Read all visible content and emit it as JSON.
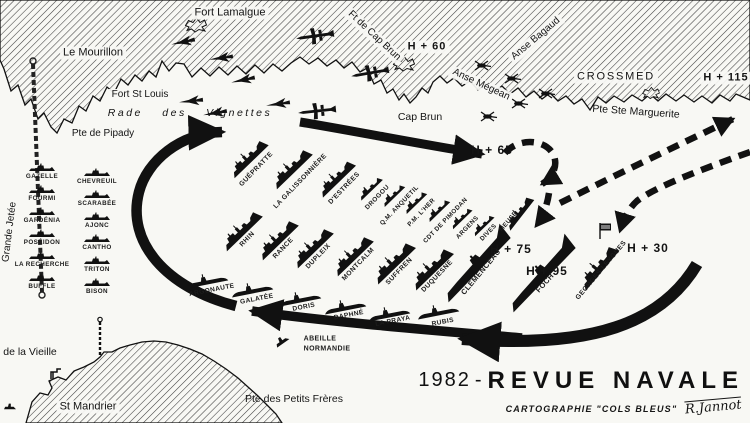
{
  "title_block": {
    "year": "1982",
    "sep": "-",
    "title": "REVUE NAVALE",
    "credit": "CARTOGRAPHIE \"COLS BLEUS\"",
    "signature": "R.Jannot"
  },
  "colors": {
    "ink": "#111111",
    "paper": "#f8f8f4",
    "hatch": "#3f3f3f"
  },
  "labels": [
    {
      "id": "fort-lamalgue",
      "t": "Fort Lamalgue",
      "x": 230,
      "y": 13,
      "fs": 11,
      "cls": "halo"
    },
    {
      "id": "le-mourillon",
      "t": "Le Mourillon",
      "x": 93,
      "y": 53,
      "fs": 11,
      "cls": "halo"
    },
    {
      "id": "fort-st-louis",
      "t": "Fort St Louis",
      "x": 140,
      "y": 95,
      "fs": 10,
      "cls": "halo"
    },
    {
      "id": "rade-des-vignettes",
      "t": "Rade des Vignettes",
      "x": 190,
      "y": 113,
      "fs": 10.5,
      "cls": "water"
    },
    {
      "id": "pte-de-pipady",
      "t": "Pte de Pipady",
      "x": 103,
      "y": 134,
      "fs": 10
    },
    {
      "id": "ft-de-cap-brun",
      "t": "Ft de Cap Brun",
      "x": 374,
      "y": 36,
      "fs": 10,
      "r": 43,
      "cls": "halo"
    },
    {
      "id": "h-60",
      "t": "H + 60",
      "x": 427,
      "y": 47,
      "fs": 11,
      "cls": "tm halo"
    },
    {
      "id": "cap-brun",
      "t": "Cap Brun",
      "x": 420,
      "y": 117,
      "fs": 10.5
    },
    {
      "id": "anse-megean",
      "t": "Anse Mégean",
      "x": 481,
      "y": 85,
      "fs": 10,
      "r": 25,
      "cls": "halo"
    },
    {
      "id": "anse-bagaud",
      "t": "Anse Bagaud",
      "x": 536,
      "y": 39,
      "fs": 10,
      "r": -40,
      "cls": "halo"
    },
    {
      "id": "crossmed",
      "t": "CROSSMED",
      "x": 616,
      "y": 77,
      "fs": 11,
      "cls": "wide halo"
    },
    {
      "id": "h-115",
      "t": "H + 115",
      "x": 726,
      "y": 78,
      "fs": 11,
      "cls": "tm halo"
    },
    {
      "id": "pte-ste-marguerite",
      "t": "Pte Ste Marguerite",
      "x": 636,
      "y": 112,
      "fs": 10.5,
      "r": 4
    },
    {
      "id": "grande-jetee",
      "t": "Grande Jetée",
      "x": 10,
      "y": 232,
      "fs": 10,
      "r": -83
    },
    {
      "id": "h-65",
      "t": "H + 65",
      "x": 492,
      "y": 150,
      "fs": 12,
      "cls": "tm"
    },
    {
      "id": "h-75",
      "t": "H + 75",
      "x": 511,
      "y": 249,
      "fs": 12,
      "cls": "tm"
    },
    {
      "id": "h-95",
      "t": "H + 95",
      "x": 547,
      "y": 271,
      "fs": 12,
      "cls": "tm"
    },
    {
      "id": "h-30",
      "t": "H + 30",
      "x": 648,
      "y": 248,
      "fs": 12,
      "cls": "tm"
    },
    {
      "id": "de-la-vieille",
      "t": "de la Vieille",
      "x": 30,
      "y": 352,
      "fs": 10.5
    },
    {
      "id": "st-mandrier",
      "t": "St Mandrier",
      "x": 88,
      "y": 407,
      "fs": 11,
      "cls": "halo"
    },
    {
      "id": "pte-des-petits-freres",
      "t": "Pte des Petits Frères",
      "x": 294,
      "y": 399,
      "fs": 10.5
    },
    {
      "id": "abeille-line1",
      "t": "ABEILLE",
      "x": 320,
      "y": 339,
      "fs": 7,
      "cls": "ship"
    },
    {
      "id": "abeille-line2",
      "t": "NORMANDIE",
      "x": 327,
      "y": 349,
      "fs": 7,
      "cls": "ship"
    },
    {
      "id": "guepratte",
      "t": "GUÉPRATTE",
      "x": 257,
      "y": 170,
      "fs": 6.8,
      "r": -46,
      "cls": "ship"
    },
    {
      "id": "la-galissonniere",
      "t": "LA GALISSONNIÈRE",
      "x": 301,
      "y": 182,
      "fs": 6.8,
      "r": -46,
      "cls": "ship"
    },
    {
      "id": "d-estrees",
      "t": "D'ESTRÉES",
      "x": 345,
      "y": 189,
      "fs": 6.8,
      "r": -46,
      "cls": "ship"
    },
    {
      "id": "drogou",
      "t": "DROGOU",
      "x": 378,
      "y": 198,
      "fs": 6.5,
      "r": -46,
      "cls": "ship"
    },
    {
      "id": "qm-anquetil",
      "t": "Q.M. ANQUETIL",
      "x": 400,
      "y": 206,
      "fs": 6.3,
      "r": -46,
      "cls": "ship"
    },
    {
      "id": "pm-lher",
      "t": "P.M. L'HER",
      "x": 422,
      "y": 213,
      "fs": 6.3,
      "r": -46,
      "cls": "ship"
    },
    {
      "id": "cdt-de-pimodan",
      "t": "CDT DE PIMODAN",
      "x": 446,
      "y": 221,
      "fs": 6.3,
      "r": -46,
      "cls": "ship"
    },
    {
      "id": "argens",
      "t": "ARGENS",
      "x": 468,
      "y": 228,
      "fs": 6.3,
      "r": -46,
      "cls": "ship"
    },
    {
      "id": "dives",
      "t": "DIVES",
      "x": 489,
      "y": 233,
      "fs": 6.3,
      "r": -46,
      "cls": "ship"
    },
    {
      "id": "rhin",
      "t": "RHIN",
      "x": 248,
      "y": 240,
      "fs": 6.8,
      "r": -46,
      "cls": "ship"
    },
    {
      "id": "rance",
      "t": "RANCE",
      "x": 284,
      "y": 249,
      "fs": 6.8,
      "r": -46,
      "cls": "ship"
    },
    {
      "id": "dupleix",
      "t": "DUPLEIX",
      "x": 319,
      "y": 257,
      "fs": 6.8,
      "r": -46,
      "cls": "ship"
    },
    {
      "id": "montcalm",
      "t": "MONTCALM",
      "x": 359,
      "y": 265,
      "fs": 6.8,
      "r": -46,
      "cls": "ship"
    },
    {
      "id": "suffren",
      "t": "SUFFREN",
      "x": 400,
      "y": 272,
      "fs": 6.8,
      "r": -46,
      "cls": "ship"
    },
    {
      "id": "duquesne",
      "t": "DUQUESNE",
      "x": 438,
      "y": 277,
      "fs": 6.8,
      "r": -46,
      "cls": "ship"
    },
    {
      "id": "clemenceau",
      "t": "CLEMENCEAU",
      "x": 481,
      "y": 272,
      "fs": 7.5,
      "r": -50,
      "cls": "ship"
    },
    {
      "id": "foch",
      "t": "FOCH",
      "x": 545,
      "y": 283,
      "fs": 7.5,
      "r": -48,
      "cls": "ship"
    },
    {
      "id": "meuse",
      "t": "MEUSE",
      "x": 509,
      "y": 222,
      "fs": 6.3,
      "r": -50,
      "cls": "ship"
    },
    {
      "id": "georges-leygues",
      "t": "GEORGES LEYGUES",
      "x": 602,
      "y": 271,
      "fs": 6.8,
      "r": -50,
      "cls": "ship"
    },
    {
      "id": "argonaute",
      "t": "ARGONAUTE",
      "x": 212,
      "y": 291,
      "fs": 6.6,
      "r": -11,
      "cls": "ship"
    },
    {
      "id": "galatee",
      "t": "GALATÉE",
      "x": 257,
      "y": 300,
      "fs": 6.6,
      "r": -11,
      "cls": "ship"
    },
    {
      "id": "doris",
      "t": "DORIS",
      "x": 304,
      "y": 308,
      "fs": 6.6,
      "r": -11,
      "cls": "ship"
    },
    {
      "id": "daphne",
      "t": "DAPHNÉ",
      "x": 349,
      "y": 316,
      "fs": 6.6,
      "r": -11,
      "cls": "ship"
    },
    {
      "id": "la-praya",
      "t": "LA PRAYA",
      "x": 393,
      "y": 322,
      "fs": 6.6,
      "r": -11,
      "cls": "ship"
    },
    {
      "id": "rubis",
      "t": "RUBIS",
      "x": 443,
      "y": 323,
      "fs": 6.6,
      "r": -11,
      "cls": "ship"
    },
    {
      "id": "gazelle",
      "t": "GAZELLE",
      "x": 42,
      "y": 177,
      "fs": 6.3,
      "cls": "ship"
    },
    {
      "id": "fourmi",
      "t": "FOURMI",
      "x": 42,
      "y": 199,
      "fs": 6.3,
      "cls": "ship"
    },
    {
      "id": "gardenia",
      "t": "GARDÉNIA",
      "x": 42,
      "y": 221,
      "fs": 6.3,
      "cls": "ship"
    },
    {
      "id": "poseidon",
      "t": "POSÉIDON",
      "x": 42,
      "y": 243,
      "fs": 6.3,
      "cls": "ship"
    },
    {
      "id": "la-recherche",
      "t": "LA RECHERCHE",
      "x": 42,
      "y": 265,
      "fs": 6.3,
      "cls": "ship"
    },
    {
      "id": "buffle",
      "t": "BUFFLE",
      "x": 42,
      "y": 287,
      "fs": 6.3,
      "cls": "ship"
    },
    {
      "id": "chevreuil",
      "t": "CHEVREUIL",
      "x": 97,
      "y": 182,
      "fs": 6.3,
      "cls": "ship"
    },
    {
      "id": "scarabee",
      "t": "SCARABÉE",
      "x": 97,
      "y": 204,
      "fs": 6.3,
      "cls": "ship"
    },
    {
      "id": "ajonc",
      "t": "AJONC",
      "x": 97,
      "y": 226,
      "fs": 6.3,
      "cls": "ship"
    },
    {
      "id": "cantho",
      "t": "CANTHO",
      "x": 97,
      "y": 248,
      "fs": 6.3,
      "cls": "ship"
    },
    {
      "id": "triton",
      "t": "TRITON",
      "x": 97,
      "y": 270,
      "fs": 6.3,
      "cls": "ship"
    },
    {
      "id": "bison",
      "t": "BISON",
      "x": 97,
      "y": 292,
      "fs": 6.3,
      "cls": "ship"
    }
  ],
  "icons": [
    {
      "id": "ship-guepratte",
      "sym": "escort",
      "x": 247,
      "y": 157,
      "r": -44,
      "s": 0.95
    },
    {
      "id": "ship-la-galissonniere",
      "sym": "escort",
      "x": 290,
      "y": 167,
      "r": -44,
      "s": 1
    },
    {
      "id": "ship-d-estrees",
      "sym": "escort",
      "x": 335,
      "y": 177,
      "r": -44,
      "s": 0.92
    },
    {
      "id": "ship-drogou",
      "sym": "aviso",
      "x": 369,
      "y": 187,
      "r": -44,
      "s": 1
    },
    {
      "id": "ship-qm-anquetil",
      "sym": "aviso",
      "x": 392,
      "y": 194,
      "r": -44,
      "s": 0.95
    },
    {
      "id": "ship-pm-lher",
      "sym": "aviso",
      "x": 414,
      "y": 201,
      "r": -44,
      "s": 0.95
    },
    {
      "id": "ship-cdt-de-pimodan",
      "sym": "aviso",
      "x": 437,
      "y": 209,
      "r": -44,
      "s": 0.95
    },
    {
      "id": "ship-argens",
      "sym": "aviso",
      "x": 460,
      "y": 217,
      "r": -44,
      "s": 0.9
    },
    {
      "id": "ship-dives",
      "sym": "aviso",
      "x": 482,
      "y": 224,
      "r": -44,
      "s": 0.9
    },
    {
      "id": "ship-rhin",
      "sym": "escort",
      "x": 240,
      "y": 229,
      "r": -44,
      "s": 1
    },
    {
      "id": "ship-rance",
      "sym": "escort",
      "x": 276,
      "y": 238,
      "r": -44,
      "s": 1
    },
    {
      "id": "ship-dupleix",
      "sym": "escort",
      "x": 311,
      "y": 246,
      "r": -44,
      "s": 1
    },
    {
      "id": "ship-montcalm",
      "sym": "escort",
      "x": 351,
      "y": 254,
      "r": -44,
      "s": 1
    },
    {
      "id": "ship-suffren",
      "sym": "escort",
      "x": 392,
      "y": 261,
      "r": -44,
      "s": 1.05
    },
    {
      "id": "ship-duquesne",
      "sym": "escort",
      "x": 430,
      "y": 267,
      "r": -44,
      "s": 1.05
    },
    {
      "id": "ship-clemenceau",
      "sym": "carrier",
      "x": 474,
      "y": 263,
      "r": -46,
      "s": 1
    },
    {
      "id": "ship-foch",
      "sym": "carrier",
      "x": 539,
      "y": 273,
      "r": -46,
      "s": 1
    },
    {
      "id": "ship-meuse",
      "sym": "escort",
      "x": 518,
      "y": 212,
      "r": -52,
      "s": 0.78
    },
    {
      "id": "ship-georges-leygues",
      "sym": "escort",
      "x": 597,
      "y": 266,
      "r": -50,
      "s": 1.05
    },
    {
      "id": "sub-argonaute",
      "sym": "sub",
      "x": 207,
      "y": 281,
      "r": -11
    },
    {
      "id": "sub-galatee",
      "sym": "sub",
      "x": 252,
      "y": 290,
      "r": -11
    },
    {
      "id": "sub-doris",
      "sym": "sub",
      "x": 300,
      "y": 299,
      "r": -11
    },
    {
      "id": "sub-daphne",
      "sym": "sub",
      "x": 345,
      "y": 307,
      "r": -11
    },
    {
      "id": "sub-la-praya",
      "sym": "sub",
      "x": 389,
      "y": 314,
      "r": -11
    },
    {
      "id": "sub-rubis",
      "sym": "sub",
      "x": 438,
      "y": 312,
      "r": -11
    },
    {
      "id": "moored-gazelle",
      "sym": "moored",
      "x": 42,
      "y": 167
    },
    {
      "id": "moored-fourmi",
      "sym": "moored",
      "x": 42,
      "y": 189
    },
    {
      "id": "moored-gardenia",
      "sym": "moored",
      "x": 42,
      "y": 211
    },
    {
      "id": "moored-poseidon",
      "sym": "moored",
      "x": 42,
      "y": 233
    },
    {
      "id": "moored-la-recherche",
      "sym": "moored",
      "x": 42,
      "y": 255
    },
    {
      "id": "moored-buffle",
      "sym": "moored",
      "x": 42,
      "y": 277
    },
    {
      "id": "moored-chevreuil",
      "sym": "moored",
      "x": 97,
      "y": 172
    },
    {
      "id": "moored-scarabee",
      "sym": "moored",
      "x": 97,
      "y": 194
    },
    {
      "id": "moored-ajonc",
      "sym": "moored",
      "x": 97,
      "y": 216
    },
    {
      "id": "moored-cantho",
      "sym": "moored",
      "x": 97,
      "y": 238
    },
    {
      "id": "moored-triton",
      "sym": "moored",
      "x": 97,
      "y": 260
    },
    {
      "id": "moored-bison",
      "sym": "moored",
      "x": 97,
      "y": 282
    },
    {
      "id": "jet-1",
      "sym": "jet",
      "x": 183,
      "y": 42,
      "r": -12
    },
    {
      "id": "jet-2",
      "sym": "jet",
      "x": 221,
      "y": 58,
      "r": -8
    },
    {
      "id": "jet-3",
      "sym": "jet",
      "x": 243,
      "y": 80,
      "r": -12
    },
    {
      "id": "jet-4",
      "sym": "jet",
      "x": 191,
      "y": 101,
      "r": -6
    },
    {
      "id": "jet-5",
      "sym": "jet",
      "x": 215,
      "y": 113,
      "r": -10
    },
    {
      "id": "jet-6",
      "sym": "jet",
      "x": 278,
      "y": 104,
      "r": -8
    },
    {
      "id": "patrol-plane-1",
      "sym": "patrol",
      "x": 315,
      "y": 36,
      "r": -8
    },
    {
      "id": "patrol-plane-2",
      "sym": "patrol",
      "x": 370,
      "y": 73,
      "r": -10
    },
    {
      "id": "patrol-plane-3",
      "sym": "patrol",
      "x": 317,
      "y": 111,
      "r": -6
    },
    {
      "id": "helicopter-1",
      "sym": "heli",
      "x": 483,
      "y": 66
    },
    {
      "id": "helicopter-2",
      "sym": "heli",
      "x": 489,
      "y": 117
    },
    {
      "id": "helicopter-3",
      "sym": "heli",
      "x": 513,
      "y": 79
    },
    {
      "id": "helicopter-4",
      "sym": "heli",
      "x": 547,
      "y": 94
    },
    {
      "id": "helicopter-5",
      "sym": "heli",
      "x": 520,
      "y": 104
    },
    {
      "id": "fort-lamalgue",
      "sym": "fort",
      "x": 196,
      "y": 25
    },
    {
      "id": "fort-cap-brun",
      "sym": "fort",
      "x": 404,
      "y": 64
    },
    {
      "id": "fort-ste-marguerite",
      "sym": "fort",
      "x": 651,
      "y": 93,
      "s": 0.8
    },
    {
      "id": "flag-marker",
      "sym": "flag",
      "x": 605,
      "y": 231
    },
    {
      "id": "antenna-mast",
      "sym": "mast",
      "x": 100,
      "y": 336
    },
    {
      "id": "crane-structure",
      "sym": "crane",
      "x": 56,
      "y": 374
    },
    {
      "id": "tug-abeille",
      "sym": "tug",
      "x": 281,
      "y": 340,
      "r": -35
    },
    {
      "id": "small-boat",
      "sym": "tug",
      "x": 10,
      "y": 406,
      "s": 0.8
    }
  ]
}
